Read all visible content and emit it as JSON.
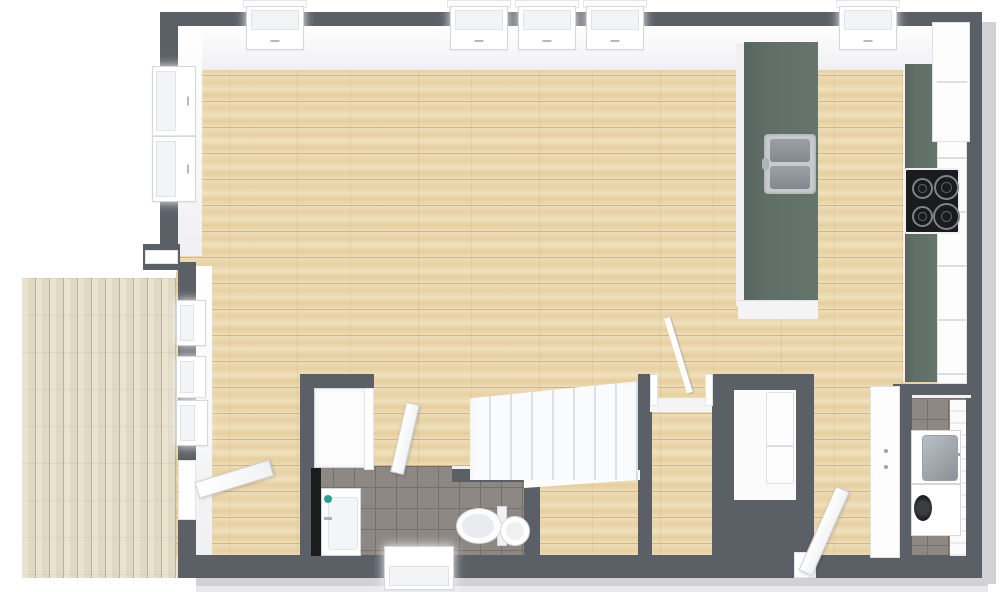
{
  "meta": {
    "type": "floor-plan-3d-top-view",
    "view": "overhead-dollhouse-render",
    "visible_text": "none"
  },
  "palette": {
    "wall": "#5b6067",
    "wood": "#ead7b0",
    "deck": "#e6dfcc",
    "counter_green": "#5f6e66",
    "tile": "#8d8883",
    "tile_grout": "#767069",
    "fixture_white": "#ffffff",
    "steel": "#99a0a5",
    "cooktop_black": "#1a1b1d",
    "ground_shadow": "#d2d2d6",
    "soap_teal": "#2e9e94"
  },
  "rooms": [
    {
      "name": "living-room-kitchen",
      "floor": "light-oak-plank",
      "position": "main-open-area"
    },
    {
      "name": "deck",
      "floor": "weathered-wood-plank",
      "position": "outside-left"
    },
    {
      "name": "bathroom",
      "floor": "gray-tile",
      "fixtures": [
        "shower",
        "vanity-sink",
        "toilet",
        "round-basin",
        "window"
      ],
      "position": "bottom-center-left"
    },
    {
      "name": "stair-hall",
      "floor": "light-oak-plank",
      "fixtures": [
        "staircase",
        "railing"
      ],
      "position": "bottom-center"
    },
    {
      "name": "closet",
      "floor": "white",
      "fixtures": [
        "shelf-unit"
      ],
      "position": "bottom-center-right"
    },
    {
      "name": "laundry-room",
      "floor": "gray-tile",
      "fixtures": [
        "utility-sink",
        "washing-machine"
      ],
      "position": "bottom-right"
    }
  ],
  "kitchen": {
    "island": {
      "countertop_color": "green",
      "sink": "double-basin-stainless",
      "base": "white-cabinets"
    },
    "wall_counter": {
      "countertop_color": "green",
      "cooktop_burners": 4,
      "cabinets": "white",
      "tall_cabinet": "white-fridge-unit"
    }
  },
  "stairs": {
    "treads": 8,
    "tread_seam_px": 21,
    "enclosure": "dark-wall-right-and-below"
  },
  "windows": {
    "top_wall": 5,
    "left_wall_upper": 2,
    "left_wall_lower": 3,
    "bottom_wall": 1
  },
  "doors": {
    "deck_door": "open-into-living-room",
    "bathroom_door": "open",
    "hall_doorway": "open-no-leaf",
    "laundry_door": "open",
    "rear_door_bottom_right": "open"
  },
  "furniture": {
    "hall_wardrobe": "white-double-door-cabinet"
  }
}
